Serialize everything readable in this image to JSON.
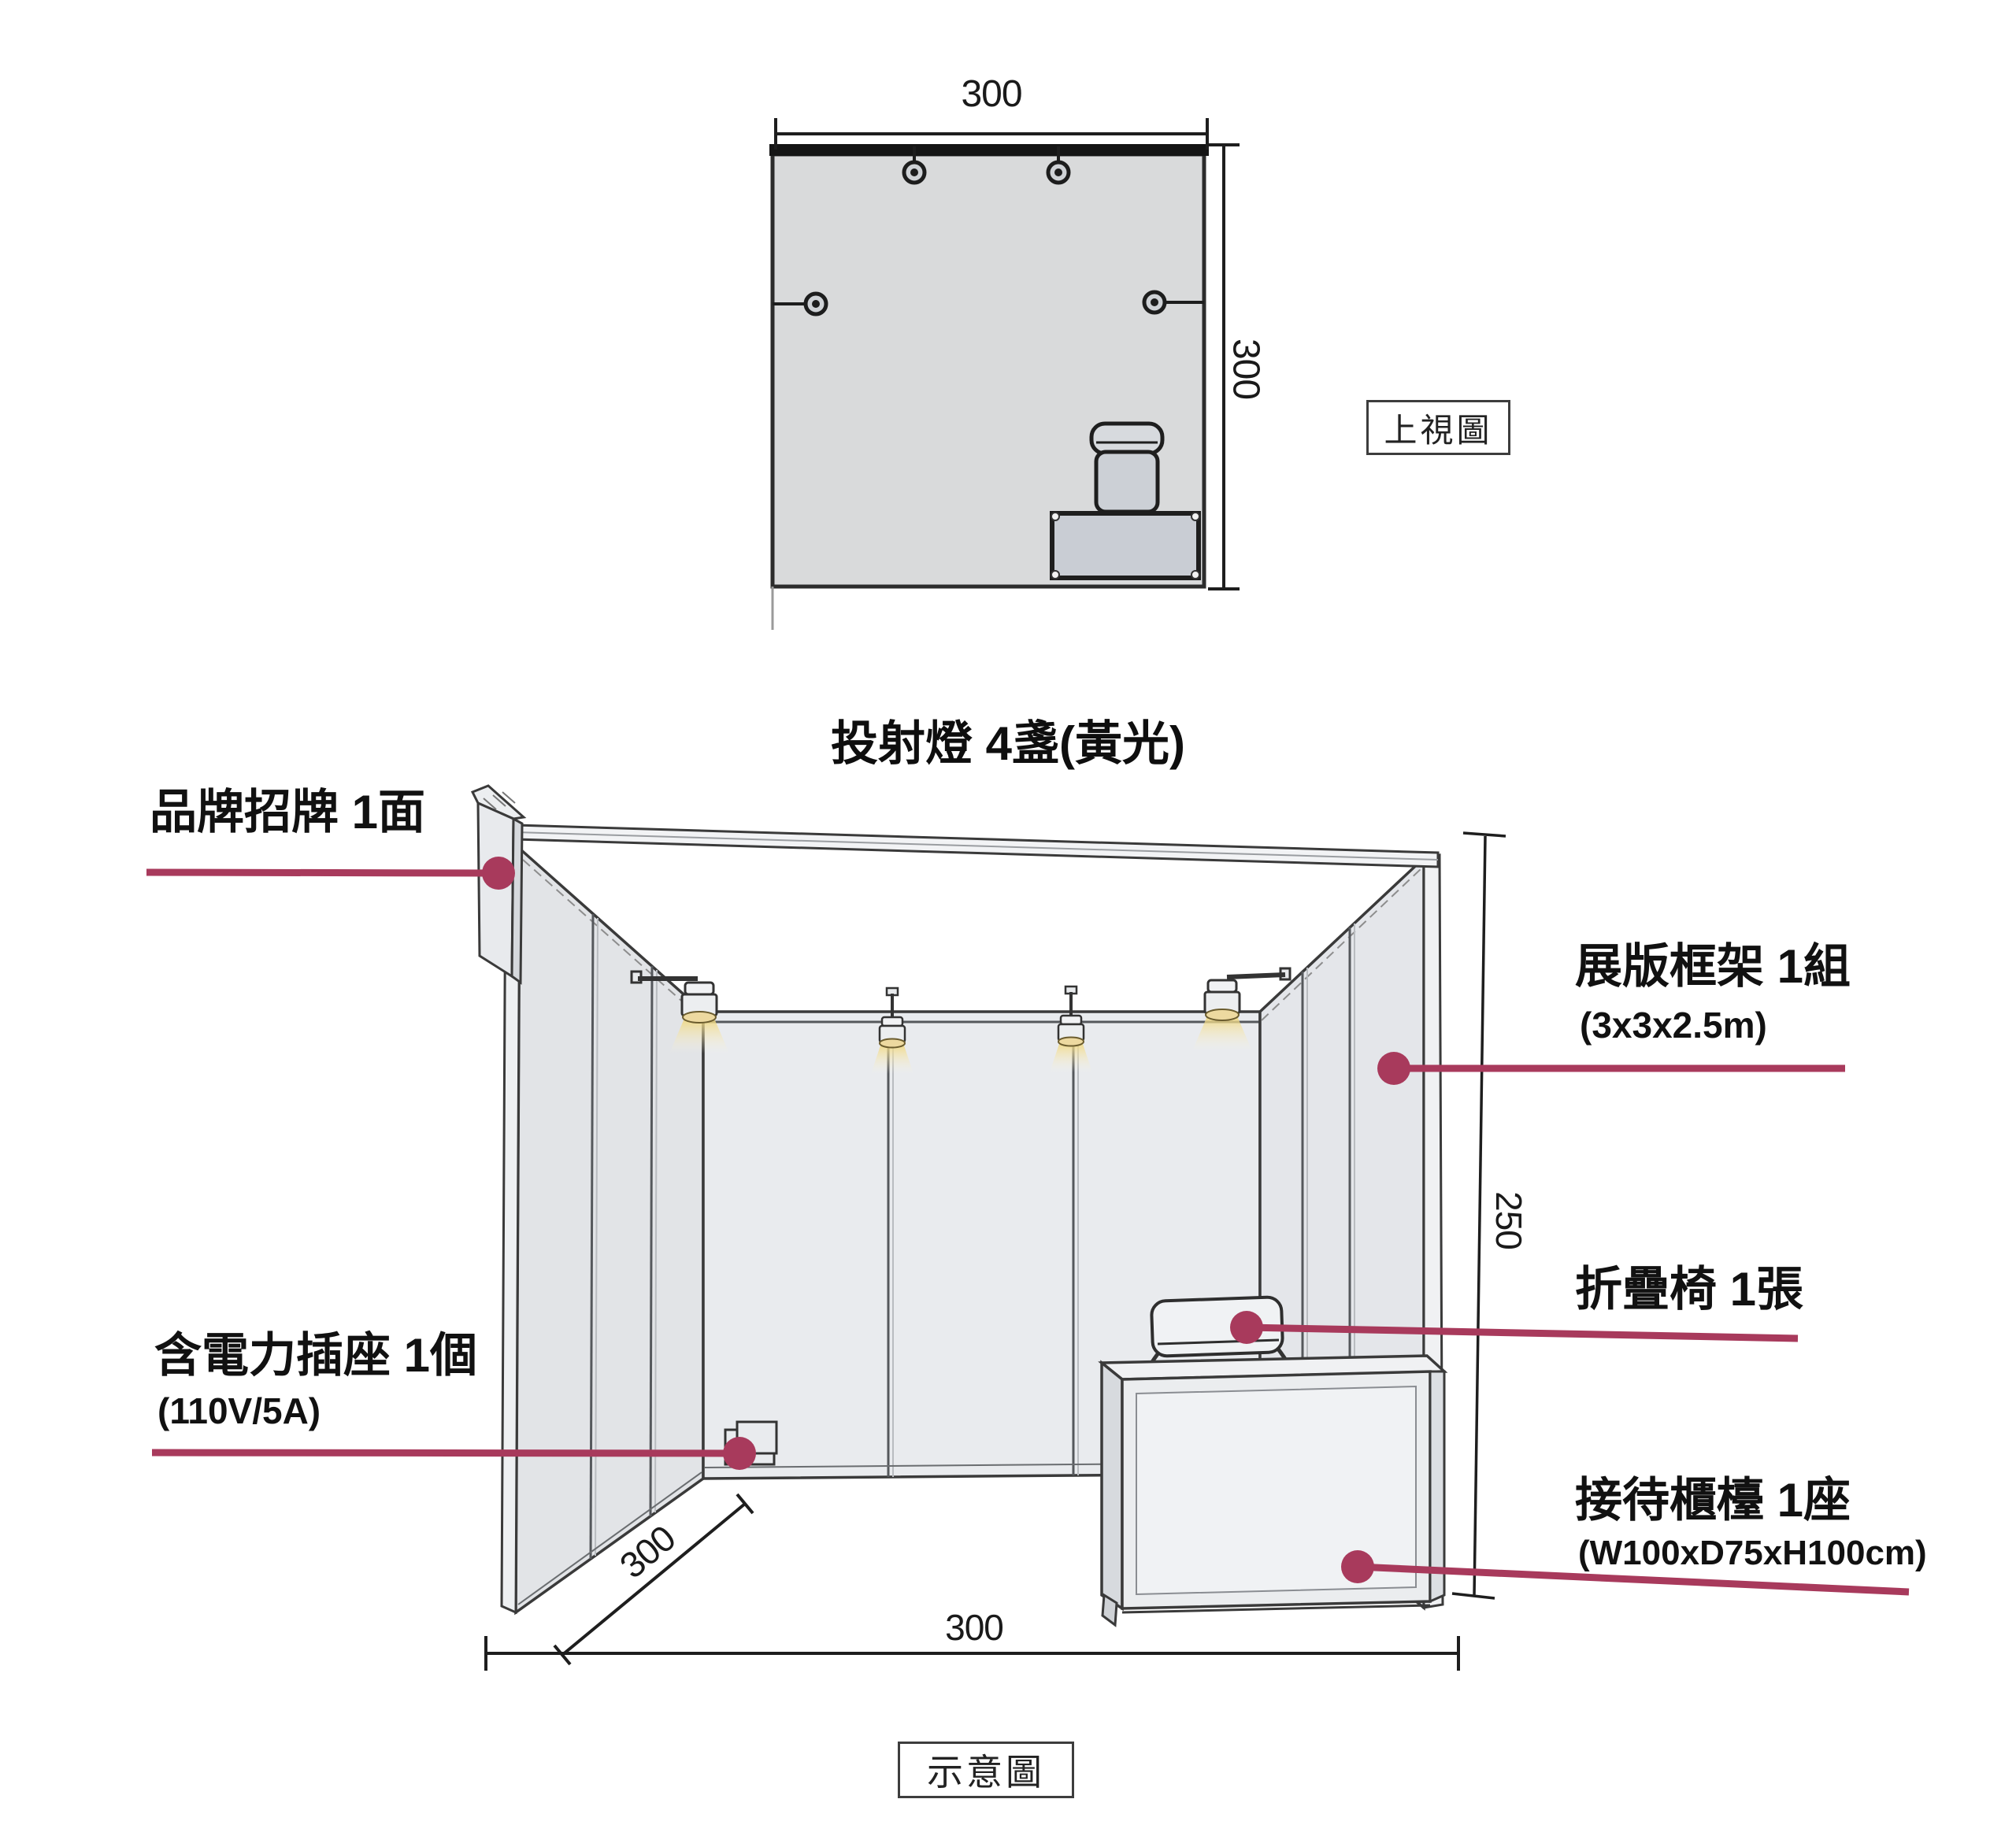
{
  "colors": {
    "accent": "#a83a5c",
    "line": "#3a3a3a",
    "plan_fill": "#d9dadb",
    "wall_fill": "#e7e9ec",
    "counter_fill": "#c9cdd4",
    "glow": "#f0dc9e"
  },
  "top_view": {
    "tag": "上視圖",
    "width_label": "300",
    "depth_label": "300"
  },
  "scene": {
    "tag": "示意圖",
    "title": "投射燈 4盞(黃光)",
    "bottom_width_label": "300",
    "side_depth_label": "300",
    "height_label": "250",
    "callouts": {
      "signboard": {
        "label": "品牌招牌 1面"
      },
      "frame": {
        "label": "展版框架 1組",
        "sub": "(3x3x2.5m)"
      },
      "chair": {
        "label": "折疊椅 1張"
      },
      "socket": {
        "label": "含電力插座 1個",
        "sub": "(110V/5A)"
      },
      "counter": {
        "label": "接待櫃檯 1座",
        "sub": "(W100xD75xH100cm)"
      }
    }
  }
}
